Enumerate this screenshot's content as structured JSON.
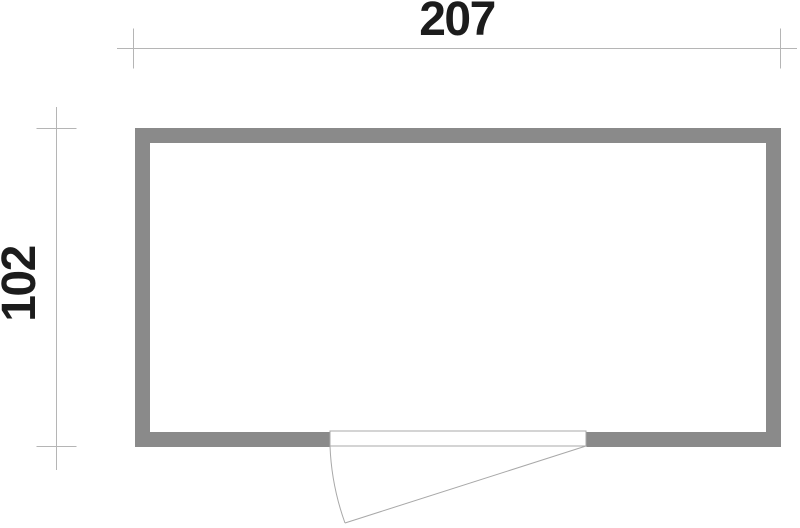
{
  "floor_plan": {
    "width_dimension": {
      "label": "207"
    },
    "height_dimension": {
      "label": "102"
    },
    "door_symbol": "single-swing-door-bottom-wall",
    "colors": {
      "wall": "#8a8a8a",
      "dimension_line": "#b5b5b5",
      "door_line": "#a8a8a8",
      "label_text": "#1c1c1c",
      "background": "#ffffff"
    }
  }
}
